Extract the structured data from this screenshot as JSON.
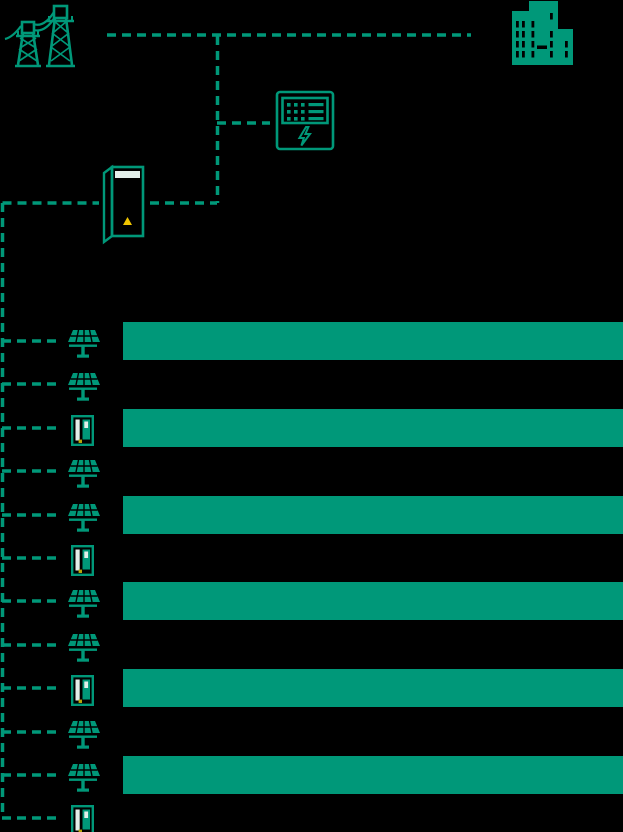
{
  "meta": {
    "colors": {
      "background": "#000000",
      "accent": "#009879",
      "panel-white": "#e3efea",
      "warning-yellow": "#efc400",
      "warning-amber": "#b7a407"
    }
  },
  "diagram": {
    "nodes": [
      {
        "id": "grid",
        "icon": "transmission-tower-icon"
      },
      {
        "id": "building",
        "icon": "office-building-icon"
      },
      {
        "id": "meter",
        "icon": "power-meter-icon"
      },
      {
        "id": "storage",
        "icon": "battery-cabinet-icon"
      }
    ],
    "devices": [
      {
        "type": "solar-panel",
        "highlight_bar": true
      },
      {
        "type": "solar-panel",
        "highlight_bar": false
      },
      {
        "type": "ev-charger",
        "highlight_bar": true
      },
      {
        "type": "solar-panel",
        "highlight_bar": false
      },
      {
        "type": "solar-panel",
        "highlight_bar": true
      },
      {
        "type": "ev-charger",
        "highlight_bar": false
      },
      {
        "type": "solar-panel",
        "highlight_bar": true
      },
      {
        "type": "solar-panel",
        "highlight_bar": false
      },
      {
        "type": "ev-charger",
        "highlight_bar": true
      },
      {
        "type": "solar-panel",
        "highlight_bar": false
      },
      {
        "type": "solar-panel",
        "highlight_bar": true
      },
      {
        "type": "ev-charger",
        "highlight_bar": false
      }
    ]
  }
}
